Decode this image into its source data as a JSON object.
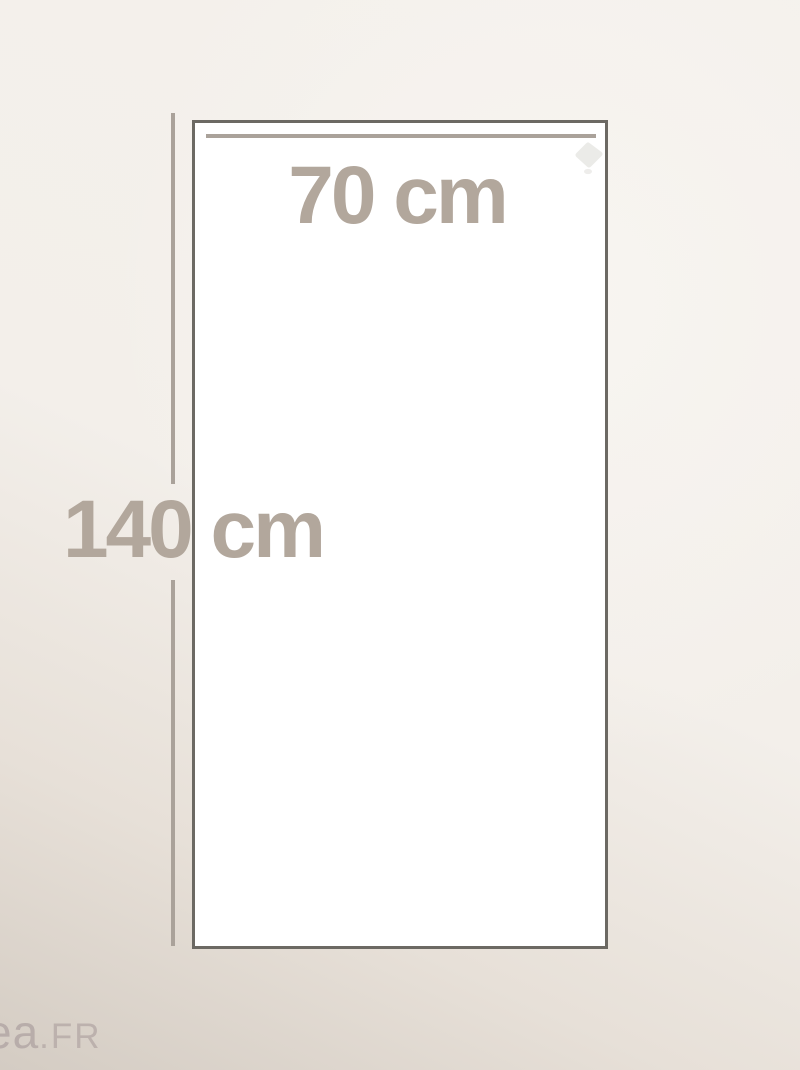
{
  "dimension_diagram": {
    "type": "product-size-guide",
    "width_label": {
      "value": "70",
      "unit": "cm",
      "text": "70 cm"
    },
    "height_label": {
      "value": "140",
      "unit": "cm",
      "text": "140 cm"
    }
  },
  "watermark": {
    "name": "ea",
    "tld": ".FR"
  },
  "icons": {
    "corner": "rotate-hint-icon"
  },
  "colors": {
    "background_light": "#f4f1ec",
    "background_shade": "#d4ccc3",
    "panel_fill": "#ffffff",
    "panel_border": "#6c6963",
    "measure_line": "#aaa29a",
    "dimension_text": "#b2a79c",
    "watermark_text": "#b8adaa",
    "corner_icon": "#ebebe8"
  }
}
